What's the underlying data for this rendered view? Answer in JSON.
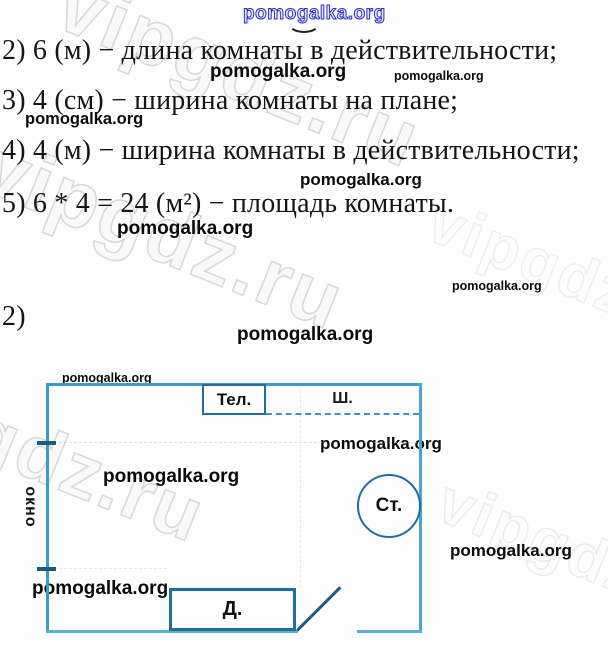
{
  "watermark": {
    "pomogalka": "pomogalka.org",
    "vipgdz": "vipgdz.ru"
  },
  "solution": {
    "line2": "2) 6 (м) − длина комнаты в действительности;",
    "line3": "3) 4 (см) − ширина комнаты на плане;",
    "line4": "4) 4 (м) − ширина комнаты в действительности;",
    "line5": "5) 6 * 4 = 24 (м²) − площадь комнаты.",
    "part_label": "2)"
  },
  "diagram": {
    "tv_label": "Тел.",
    "wardrobe_label": "Ш.",
    "window_label": "окно",
    "table_label": "Ст.",
    "sofa_label": "Д."
  },
  "colors": {
    "wall_blue": "#3c9cc6",
    "furniture_blue": "#1e6f9e",
    "dark_line": "#1d5a86",
    "watermark_gray": "#d8d8d8",
    "blue_watermark": "#2d2dc6"
  }
}
